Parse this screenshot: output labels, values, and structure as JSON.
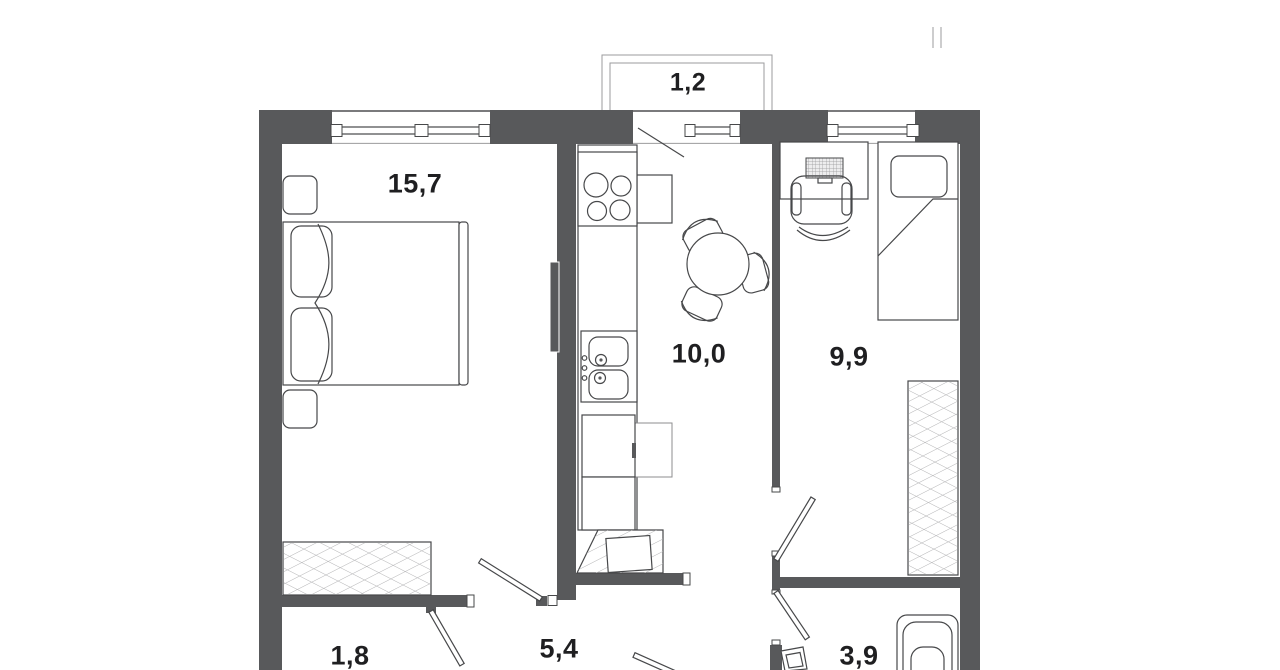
{
  "colors": {
    "background": "#FFFFFF",
    "wall": "#58595B",
    "line": "#47484A",
    "thin": "#9B9B9D",
    "hatch": "#B4B4B6",
    "label": "#1F1F21"
  },
  "rooms": {
    "living_room": {
      "area_label": "15,7"
    },
    "balcony": {
      "area_label": "1,2"
    },
    "kitchen": {
      "area_label": "10,0"
    },
    "bedroom": {
      "area_label": "9,9"
    },
    "hallway": {
      "area_label": "5,4"
    },
    "storage": {
      "area_label": "1,8"
    },
    "bathroom": {
      "area_label": "3,9"
    }
  },
  "icons": [
    "double-bed-icon",
    "nightstand-icon",
    "wardrobe-icon",
    "radiator-icon",
    "stove-icon",
    "kitchen-sink-icon",
    "refrigerator-icon",
    "kitchen-cabinet-icon",
    "washing-machine-icon",
    "dining-table-icon",
    "chair-icon",
    "desk-icon",
    "laptop-icon",
    "office-chair-icon",
    "single-bed-icon",
    "bathtub-icon",
    "washbasin-icon",
    "window-icon",
    "door-swing-icon",
    "balcony-icon",
    "vent-pipe-icon"
  ]
}
